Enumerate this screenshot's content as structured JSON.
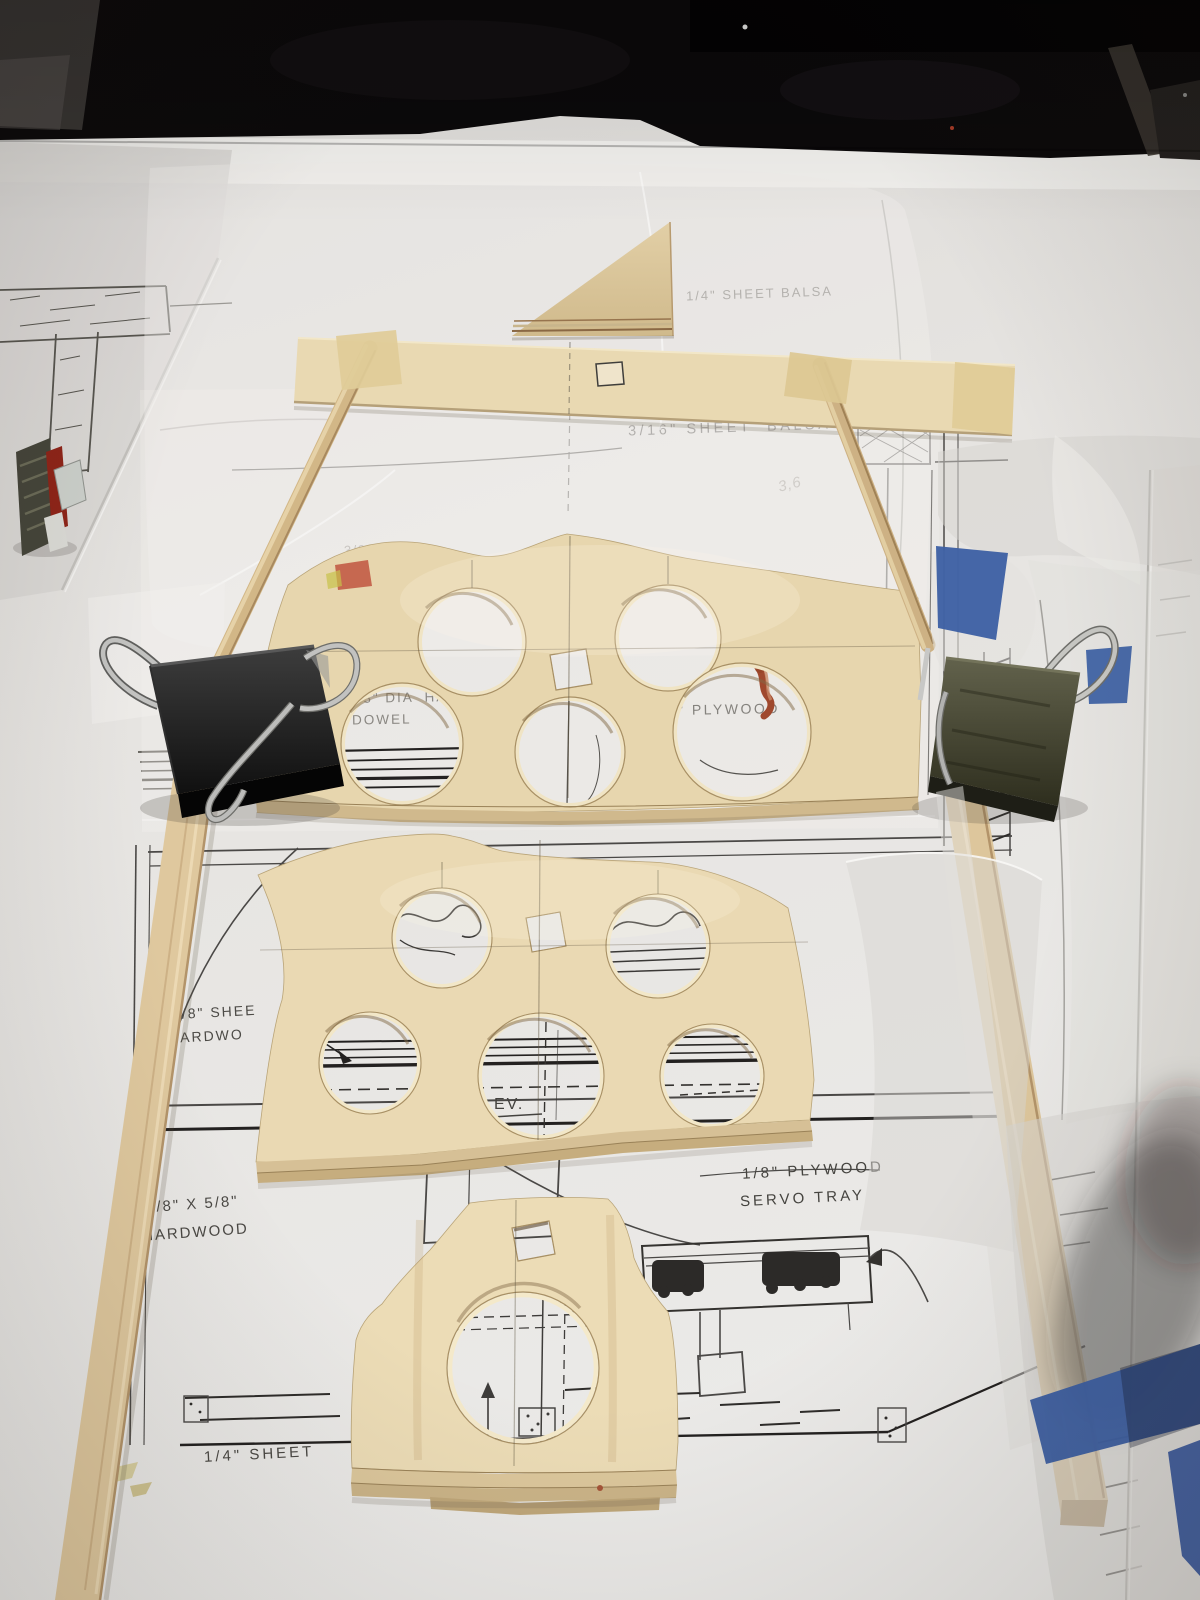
{
  "labels": {
    "sheet_balsa_quarter": "1/4\" SHEET BALSA",
    "sheet_balsa_316": "3/16\" SHEET  BALSA",
    "partial_dia": "3/8\" DI",
    "dia_hardwood": "3/8\" DIA  HAR",
    "dowel": "DOWEL",
    "fragment_o": "O",
    "plywood": "\" PLYWOOD",
    "sheet_hardwood_1": "3/8\" SHEE",
    "sheet_hardwood_2": "HARDWO",
    "servo": "SERVO",
    "servo_tray_1": "1/8\" PLYWOOD",
    "servo_tray_2": "SERVO TRAY",
    "hardwood_dim_1": "3/8\" X 5/8\"",
    "hardwood_dim_2": "HARDWOOD",
    "sheet_quarter": "1/4\" SHEET",
    "elev_fragment": "EV.",
    "pencil_note": "3,6"
  },
  "colors": {
    "paper": "#e7e5e2",
    "paper-bright": "#f0efec",
    "background-dark": "#0b090a",
    "plan-ink": "#4a4846",
    "plan-ink-dark": "#232120",
    "plywood": "#e7d6ae",
    "plywood-2": "#ead9b3",
    "plywood-edge": "#cdb78c",
    "dowel": "#d2b787",
    "stick": "#dfc89e",
    "clip-black": "#141414",
    "clip-olive": "#4a4a38",
    "clip-wire": "#c2c2c0",
    "tape-blue": "#3c5fa3",
    "tape-masking": "#e0cc98",
    "stain-red": "#a0492e",
    "plastic": "#d8d6d2"
  }
}
